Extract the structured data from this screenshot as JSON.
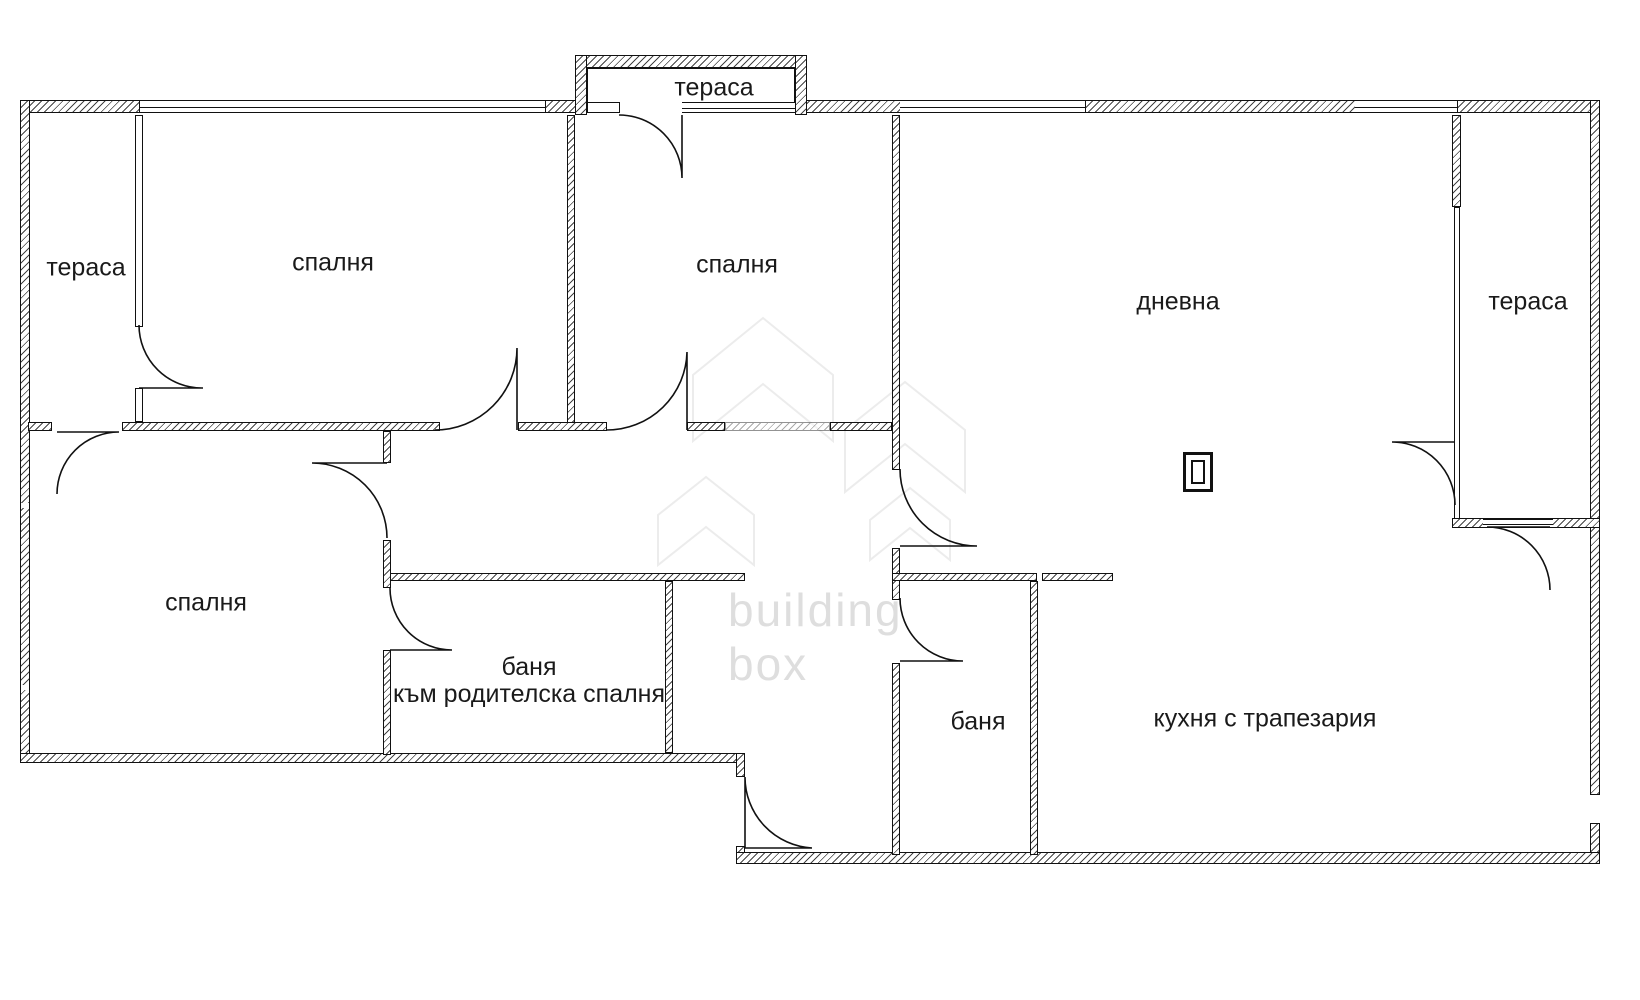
{
  "meta": {
    "drawing_type": "apartment floor plan"
  },
  "colors": {
    "wall": "#111111",
    "label": "#1a1a1a",
    "watermark": "#dedede"
  },
  "watermark": {
    "line1": "building",
    "line2": "box"
  },
  "rooms": [
    {
      "id": "terrace-top",
      "label": "тераса"
    },
    {
      "id": "bedroom-1",
      "label": "спалня"
    },
    {
      "id": "bedroom-2",
      "label": "спалня"
    },
    {
      "id": "terrace-left",
      "label": "тераса"
    },
    {
      "id": "living-room",
      "label": "дневна"
    },
    {
      "id": "terrace-right",
      "label": "тераса"
    },
    {
      "id": "bedroom-3",
      "label": "спалня"
    },
    {
      "id": "bath-parent",
      "label": "баня",
      "sublabel": "към родителска спалня"
    },
    {
      "id": "bath-small",
      "label": "баня"
    },
    {
      "id": "kitchen",
      "label": "кухня с трапезария"
    }
  ]
}
